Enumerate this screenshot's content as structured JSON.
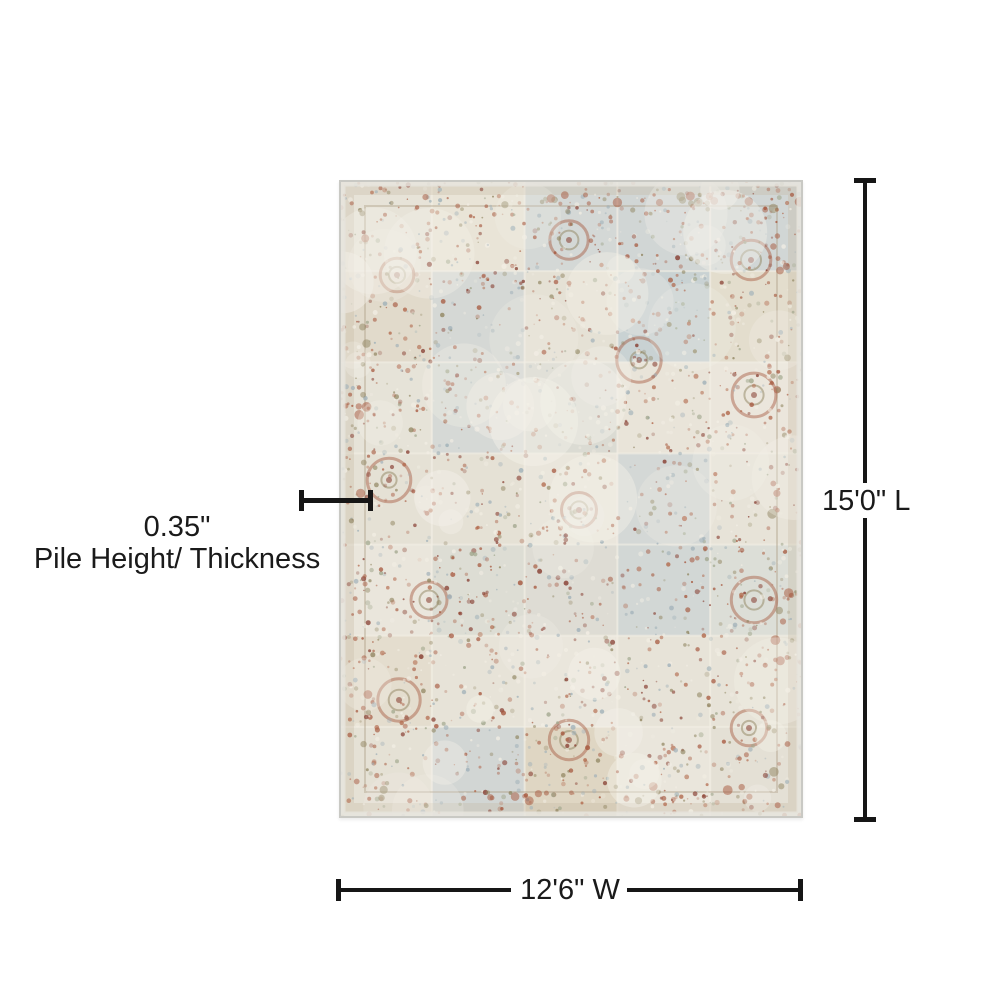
{
  "figure": {
    "description": "Top view of a distressed patchwork area rug with dimension annotations"
  },
  "annotations": {
    "length": {
      "label": "15'0\" L"
    },
    "width": {
      "label": "12'6\" W"
    },
    "pile": {
      "value": "0.35\"",
      "caption": "Pile Height/ Thickness"
    }
  },
  "colors": {
    "background": "#ffffff",
    "dimension_line": "#161616",
    "label_text": "#1a1a1a",
    "rug_palette": {
      "base": "#eae6dc",
      "patch_gray": "#d6d7d0",
      "patch_blue": "#c2ccd0",
      "patch_tan": "#d8cdb6",
      "rust": "#a5563c",
      "dark_rust": "#84392c",
      "bright_rust": "#b06548",
      "olive": "#8f845f",
      "blue_gray": "#9fb0b8",
      "sage": "#a0a68c",
      "cream_highlight": "#f2eee4",
      "edge_binding": "#c9c9c4"
    }
  }
}
